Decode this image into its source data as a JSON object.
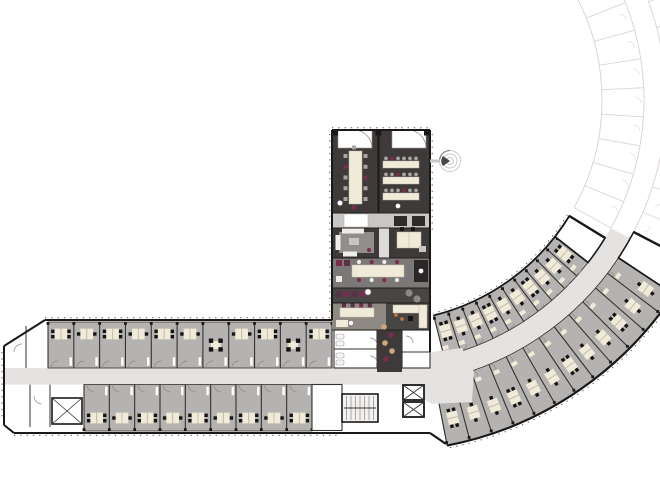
{
  "meta": {
    "title": "office-floor-plan",
    "canvas": {
      "w": 660,
      "h": 500,
      "bg": "#ffffff"
    }
  },
  "palette": {
    "bg": "#ffffff",
    "wall": "#1b1918",
    "partition": "#35322f",
    "office_gray": "#b5b3b1",
    "corridor": "#e4e3e1",
    "dark_room": "#3d3a39",
    "dark_room2": "#484545",
    "band_light": "#c9c7c5",
    "band_mid": "#7b7877",
    "band_warm": "#8e8a83",
    "desk": "#f0ead9",
    "chair": "#161414",
    "chair_gray": "#a8a5a2",
    "accent_purple": "#7c2b4e",
    "accent_orange": "#c7793d",
    "rug": "#908d8b",
    "ghost": "#d9d7d5",
    "ghost_light": "#e5e3e1",
    "door_arc": "#8a8886",
    "tread": "#9a9795",
    "white": "#ffffff",
    "stool_tan": "#caa87c",
    "window_tick": "#5a5755"
  },
  "ghost_wing": {
    "cx": 380,
    "cy": 100,
    "a0": -28,
    "a1": 29,
    "r_inner": 222,
    "r_c0": 264,
    "r_c1": 286,
    "r_outer": 352,
    "r_outer2": 370,
    "radials_inner": 9,
    "radials_outer": 10,
    "stair_block": {
      "x": 622,
      "y": 240,
      "w": 19,
      "h": 28,
      "rot": -22
    }
  },
  "curved_wing": {
    "cx": 380,
    "cy": 100,
    "corridor": {
      "r0": 264,
      "r1": 286,
      "a0": 29,
      "a1": 79
    },
    "inner_band": {
      "r0": 222,
      "r1": 264,
      "a0": 38,
      "a1": 76,
      "rooms": 10,
      "desk_r": 240,
      "side_r": 256,
      "end_white": {
        "a0": 31.5,
        "a1": 38
      }
    },
    "outer_band": {
      "r0": 286,
      "r1": 352,
      "a0": 33.5,
      "a1": 79,
      "rooms": 12,
      "desk_r": 326,
      "side_r": 296,
      "end_white": {
        "a0": 27.5,
        "a1": 33.5
      }
    }
  },
  "horizontal_wing": {
    "top_wall_y": 320,
    "bottom_wall_y": 433,
    "bevel_top": [
      [
        45,
        320
      ],
      [
        4,
        346
      ]
    ],
    "bevel_bottom": [
      [
        4,
        425
      ],
      [
        14,
        433
      ]
    ],
    "left_wall_x": 4,
    "corridor": {
      "x0": 4,
      "y0": 368,
      "x1": 436,
      "y1": 384.5
    },
    "lobby_poly": [
      [
        402,
        366
      ],
      [
        432,
        352
      ],
      [
        462,
        348
      ],
      [
        474,
        372
      ],
      [
        472,
        402
      ],
      [
        432,
        404
      ],
      [
        402,
        386
      ]
    ],
    "top_rooms": {
      "x0": 48,
      "x1": 332,
      "y0": 322,
      "y1": 368,
      "count": 11,
      "meeting": [
        6,
        9
      ],
      "desk_y": 334
    },
    "bottom_rooms": {
      "x0": 84,
      "x1": 312,
      "y0": 384.5,
      "y1": 431,
      "count": 9,
      "meeting": [],
      "desk_y": 418
    },
    "left_block": {
      "partitions_top": [
        26,
        48
      ],
      "partitions_bottom": [
        30,
        50
      ],
      "shaft": {
        "x": 52,
        "y": 398,
        "w": 30,
        "h": 26
      }
    },
    "stair": {
      "x": 342,
      "y": 394,
      "w": 36,
      "h": 28,
      "treads": 8
    },
    "elevators": [
      {
        "x": 403,
        "y": 385,
        "w": 21,
        "h": 15
      },
      {
        "x": 403,
        "y": 402,
        "w": 21,
        "h": 15
      }
    ],
    "white_room_right": {
      "x": 312,
      "y": 384.5,
      "w": 30,
      "h": 46
    }
  },
  "vertical_wing": {
    "x0": 332,
    "x1": 430,
    "y_top": 130,
    "y_bottom": 330,
    "top_block": {
      "y0": 130,
      "y1": 213,
      "divider_x": 378.5,
      "doors": [
        [
          338,
          130,
          34,
          18
        ],
        [
          392,
          130,
          34,
          18
        ]
      ],
      "conf_table": [
        349,
        151,
        13,
        53
      ],
      "conf_chairs_per_side": 5,
      "class_tables": [
        [
          383,
          161,
          36,
          7
        ],
        [
          383,
          177,
          36,
          7
        ],
        [
          383,
          193,
          36,
          7
        ]
      ],
      "class_chairs": 6
    },
    "cross_band": {
      "y0": 213,
      "y1": 228,
      "door_rect": [
        344,
        214,
        24,
        13
      ],
      "stools": [
        [
          394,
          216,
          13,
          10
        ],
        [
          412,
          216,
          13,
          10
        ]
      ]
    },
    "mid_strip": {
      "x0": 379,
      "x1": 389,
      "y0": 228,
      "y1": 302
    },
    "lounge": {
      "x0": 332,
      "x1": 379,
      "y0": 228,
      "y1": 258,
      "rug": [
        339,
        232,
        35,
        21
      ],
      "coffee_table": [
        349,
        238,
        10,
        7
      ]
    },
    "office_ne": {
      "x0": 389,
      "x1": 430,
      "y0": 228,
      "y1": 258,
      "desks": [
        397,
        232,
        24,
        16
      ]
    },
    "canteen": {
      "y0": 258,
      "y1": 288,
      "table": [
        352,
        265,
        52,
        12
      ],
      "cabinet": [
        414,
        260,
        14,
        22
      ]
    },
    "phone_band": {
      "y0": 288,
      "y1": 303,
      "seats": [
        [
          336,
          291
        ],
        [
          344,
          291
        ],
        [
          352,
          291
        ],
        [
          360,
          291
        ]
      ],
      "swivel": [
        368,
        292
      ],
      "circles": [
        [
          409,
          293
        ],
        [
          417,
          299
        ]
      ]
    },
    "work_band": {
      "y0": 303,
      "y1": 330,
      "split_x": 386,
      "desk": [
        340,
        308,
        34,
        9
      ],
      "desk2": [
        336,
        320,
        12,
        7
      ],
      "l_counter": [
        [
          393,
          305,
          34,
          8
        ],
        [
          419,
          305,
          8,
          23
        ]
      ],
      "black_chair": [
        408,
        316
      ],
      "orange_dots": [
        [
          396,
          315
        ],
        [
          402,
          319
        ]
      ]
    },
    "junction": {
      "y0": 330,
      "y1": 368,
      "toilets": {
        "x0": 334,
        "x1": 377,
        "split_y": 349
      },
      "bar": {
        "x0": 377,
        "x1": 402,
        "stools": [
          [
            384,
            327
          ],
          [
            391,
            335
          ],
          [
            385,
            343
          ],
          [
            392,
            351
          ],
          [
            386,
            359
          ]
        ]
      },
      "right_rooms": {
        "x0": 402,
        "x1": 430,
        "split_y": 352
      }
    },
    "spiral_stair": {
      "cx": 450,
      "cy": 161,
      "r": [
        10.5,
        7,
        3.5
      ]
    }
  }
}
